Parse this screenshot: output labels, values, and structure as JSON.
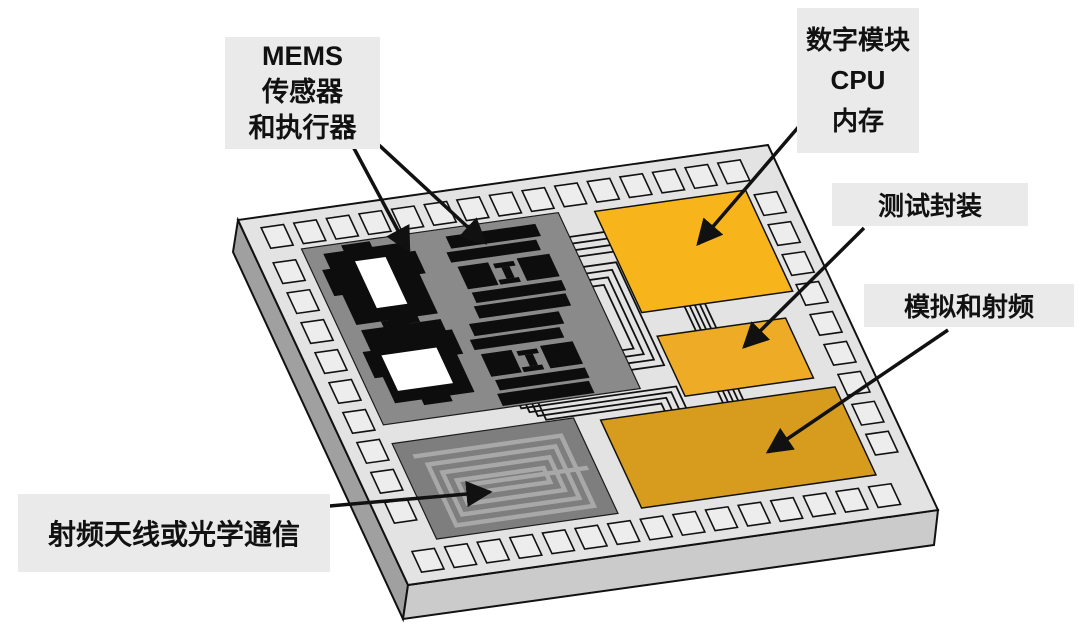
{
  "figure": {
    "kind": "isometric system-on-chip diagram",
    "background": "#ffffff"
  },
  "labels": {
    "mems": {
      "lines": [
        "MEMS",
        "传感器",
        "和执行器"
      ]
    },
    "digital": {
      "lines": [
        "数字模块",
        "CPU",
        "内存"
      ]
    },
    "test": {
      "text": "测试封装"
    },
    "analog": {
      "text": "模拟和射频"
    },
    "antenna": {
      "text": "射频天线或光学通信"
    }
  },
  "colors": {
    "label_bg": "#EAEAEA",
    "chip_top": "#E3E3E3",
    "chip_left_side": "#A0A0A0",
    "chip_front_side": "#CBCBCB",
    "pad_fill": "#EDEDED",
    "mems_region": "#8A8A8A",
    "spiral_region": "#7E7E7E",
    "spiral_line": "#A8A8A8",
    "digital_block": "#F7B41B",
    "test_block": "#EEAC26",
    "analog_block": "#D79C1E",
    "sensor_black": "#0D0D0D",
    "outline": "#111111",
    "arrow": "#111111"
  }
}
